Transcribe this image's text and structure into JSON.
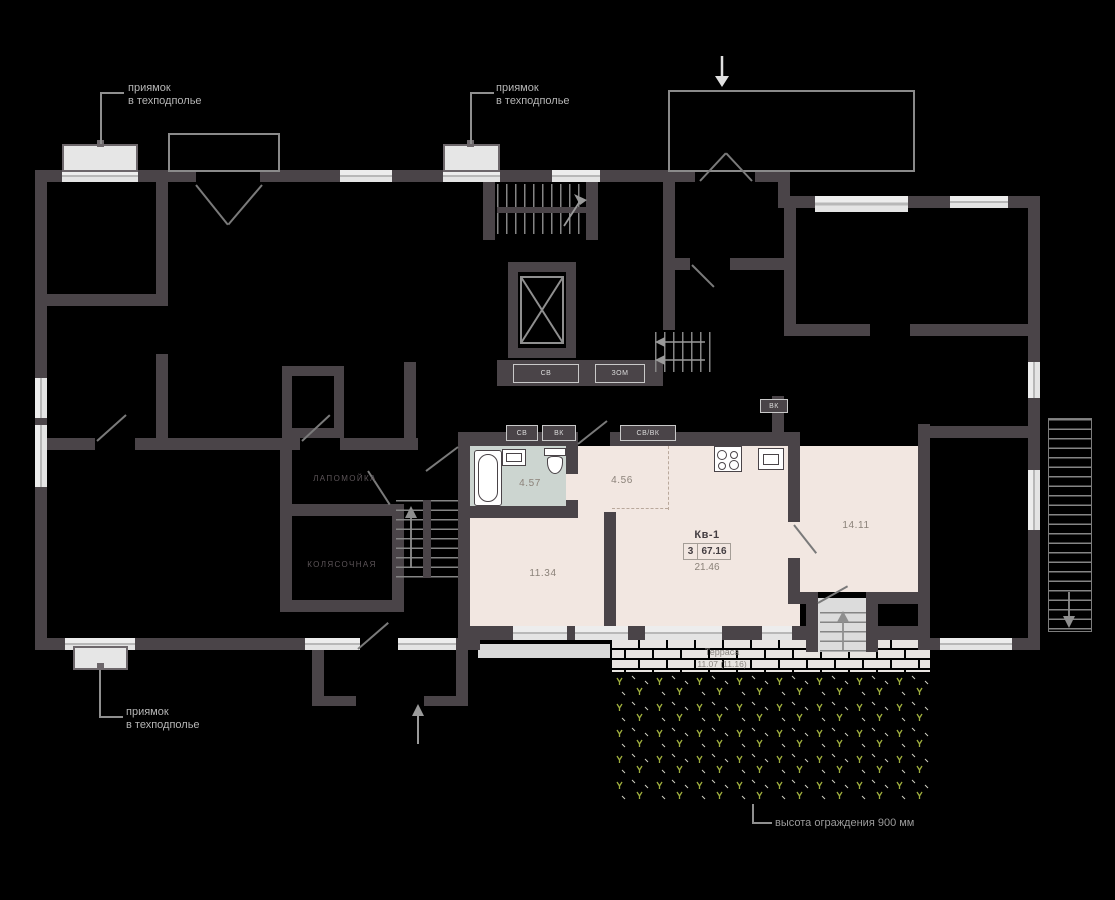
{
  "annotations": {
    "pit_top_left": {
      "line1": "приямок",
      "line2": "в техподполье"
    },
    "pit_top_center": {
      "line1": "приямок",
      "line2": "в техподполье"
    },
    "pit_bottom_left": {
      "line1": "приямок",
      "line2": "в техподполье"
    },
    "fence_note": "высота ограждения 900 мм"
  },
  "common_rooms": {
    "paw_wash": "лапомойка",
    "stroller_room": "колясочная"
  },
  "service_shafts": {
    "sv_upper": "СВ",
    "zom": "ЗОМ",
    "sv": "СВ",
    "vk": "ВК",
    "sv_vk": "СВ/ВК",
    "vk_small": "ВК"
  },
  "apartment": {
    "name": "Кв-1",
    "rooms_count": "3",
    "total_area": "67.16",
    "living_area": "21.46",
    "room_areas": {
      "bathroom": "4.57",
      "hallway": "4.56",
      "bedroom": "11.34",
      "living_room": "14.11"
    }
  },
  "terrace": {
    "name": "Терраса",
    "area": "11.07 (11.16)"
  },
  "colors": {
    "wall": "#4a4448",
    "apartment_floor": "#f2e7e1",
    "bathroom_floor": "#ccd5d0",
    "terrace_brick": "#e8e4e1",
    "lawn_green": "#9fae3e"
  }
}
